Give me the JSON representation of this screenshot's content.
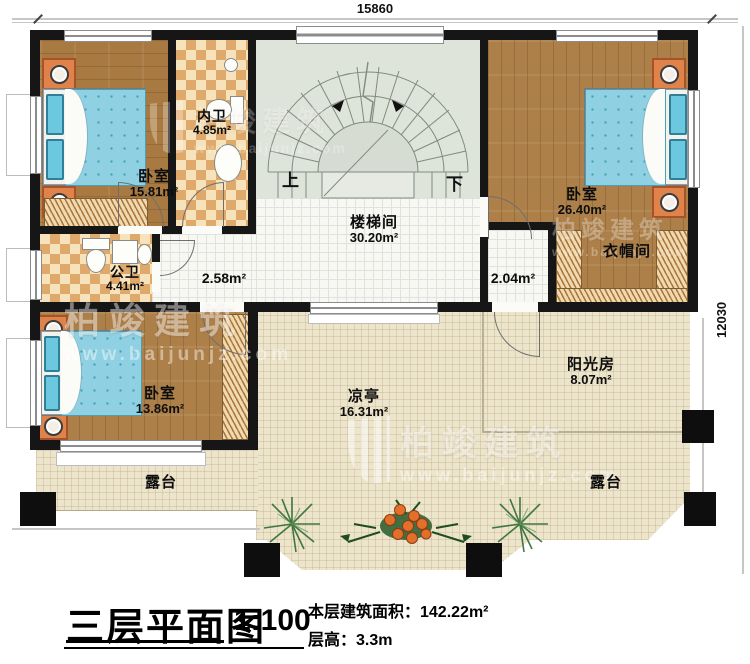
{
  "title_block": {
    "title": "三层平面图",
    "scale": "1:100",
    "area_line": "本层建筑面积：142.22m²",
    "height_line": "层高：3.3m"
  },
  "dimensions": {
    "top": "15860",
    "right": "12030"
  },
  "rooms": [
    {
      "id": "bedroom-topleft",
      "label": "卧室",
      "area": "15.81m²"
    },
    {
      "id": "inner-bath",
      "label": "内卫",
      "area": "4.85m²"
    },
    {
      "id": "stair-hall",
      "label": "楼梯间",
      "area": "30.20m²"
    },
    {
      "id": "bedroom-topright",
      "label": "卧室",
      "area": "26.40m²"
    },
    {
      "id": "cloakroom",
      "label": "衣帽间",
      "area": ""
    },
    {
      "id": "public-bath",
      "label": "公卫",
      "area": "4.41m²"
    },
    {
      "id": "corridor-left",
      "label": "",
      "area": "2.58m²"
    },
    {
      "id": "corridor-right",
      "label": "",
      "area": "2.04m²"
    },
    {
      "id": "bedroom-bottom",
      "label": "卧室",
      "area": "13.86m²"
    },
    {
      "id": "pavilion",
      "label": "凉亭",
      "area": "16.31m²"
    },
    {
      "id": "sunroom",
      "label": "阳光房",
      "area": "8.07m²"
    },
    {
      "id": "terrace-left",
      "label": "露台",
      "area": ""
    },
    {
      "id": "terrace-right",
      "label": "露台",
      "area": ""
    }
  ],
  "stairs": {
    "up": "上",
    "down": "下"
  },
  "watermark": {
    "brand": "柏竣建筑",
    "url": "www.baijunjz.com"
  },
  "colors": {
    "wall": "#161616",
    "wood_floor": "#a87a42",
    "bathroom_tile": "#e7b877",
    "bed": "#8fd0e2",
    "nightstand": "#e0834b",
    "terrace": "#ece4cb",
    "stair_floor": "#dfe4da",
    "column": "#0e0e0e"
  }
}
